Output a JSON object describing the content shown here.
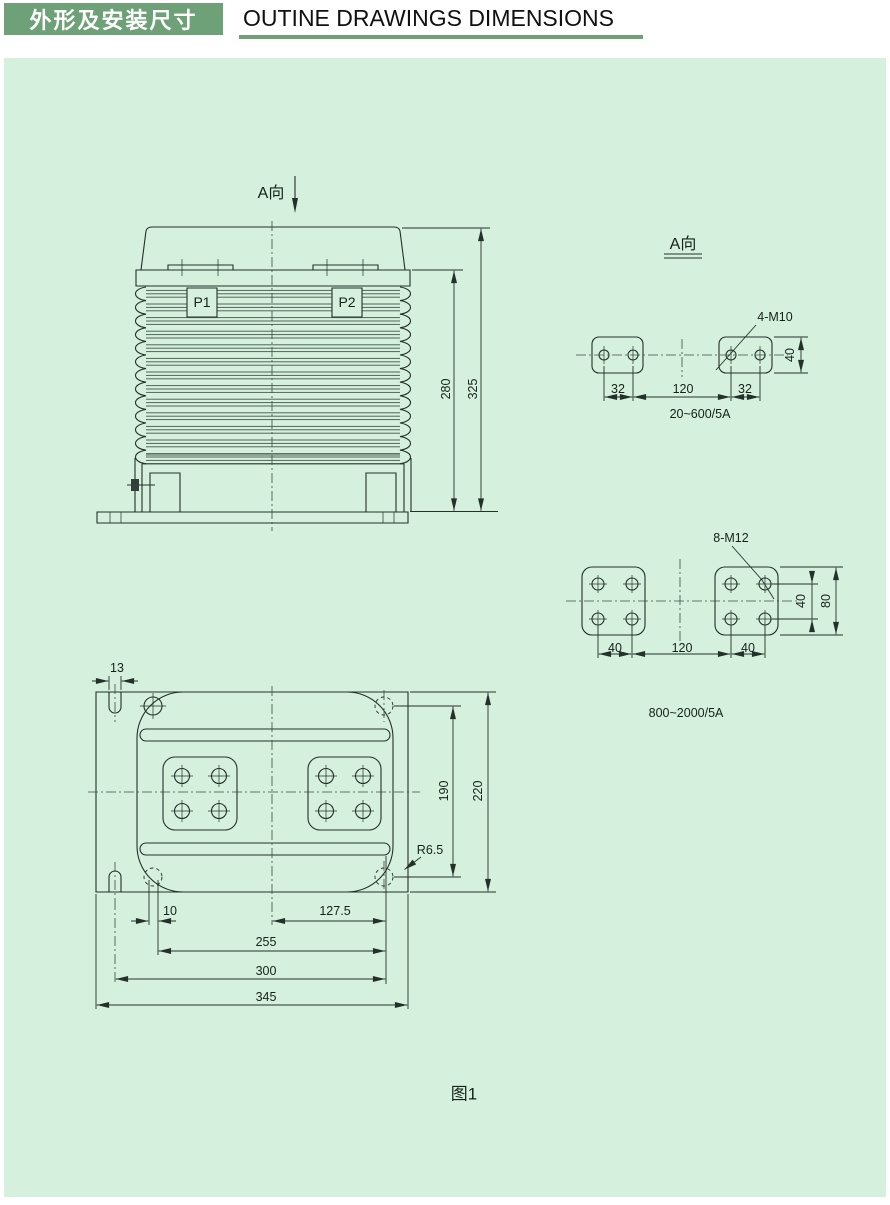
{
  "header": {
    "title_zh": "外形及安装尺寸",
    "title_en": "OUTINE DRAWINGS DIMENSIONS"
  },
  "front_view": {
    "view_label": "A向",
    "p1": "P1",
    "p2": "P2",
    "dim_280": "280",
    "dim_325": "325"
  },
  "pad_view_small": {
    "view_label": "A向",
    "thread": "4-M10",
    "dim_40": "40",
    "dim_32_left": "32",
    "dim_120": "120",
    "dim_32_right": "32",
    "range": "20~600/5A"
  },
  "pad_view_large": {
    "thread": "8-M12",
    "dim_40_rows": "40",
    "dim_80": "80",
    "dim_40_left": "40",
    "dim_120": "120",
    "dim_40_right": "40",
    "range": "800~2000/5A"
  },
  "base_view": {
    "dim_13": "13",
    "dim_190": "190",
    "dim_220": "220",
    "radius": "R6.5",
    "dim_10": "10",
    "dim_127_5": "127.5",
    "dim_255": "255",
    "dim_300": "300",
    "dim_345": "345"
  },
  "caption": "图1",
  "colors": {
    "header_green": "#6ea177",
    "panel_green": "#d5f0dc",
    "line": "#24302a"
  }
}
